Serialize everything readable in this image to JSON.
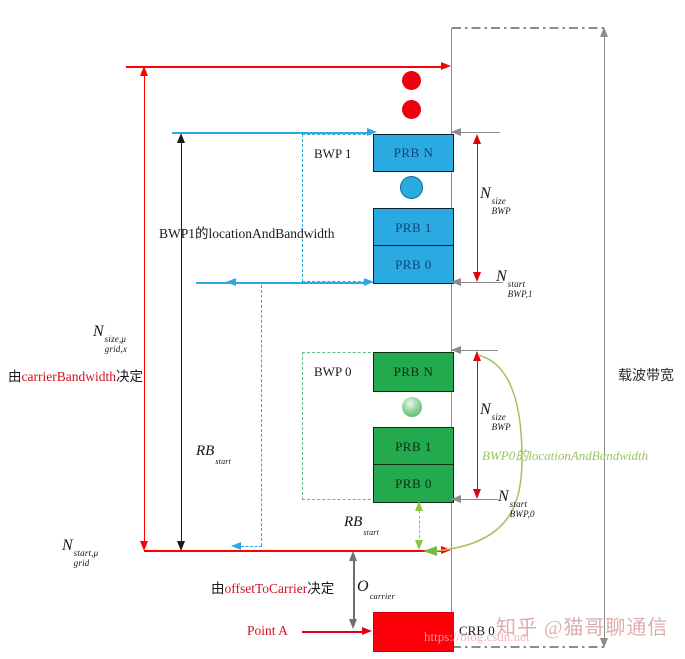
{
  "diagram": {
    "grid": {
      "n_size": {
        "base": "N",
        "sup": "size,μ",
        "sub": "grid,x"
      },
      "n_start": {
        "base": "N",
        "sup": "start,μ",
        "sub": "grid"
      },
      "carrier_note": {
        "prefix": "由",
        "keyword": "carrierBandwidth",
        "suffix": "决定"
      },
      "offset_note": {
        "prefix": "由",
        "keyword": "offsetToCarrier",
        "suffix": "决定"
      },
      "o_carrier": {
        "base": "O",
        "sub": "carrier"
      },
      "point_a_label": "Point A",
      "crb0_label": "CRB 0"
    },
    "bwp1": {
      "label": "BWP 1",
      "prb": [
        "PRB N",
        "PRB 1",
        "PRB 0"
      ],
      "location_label": "BWP1的locationAndBandwidth",
      "rb_start": {
        "base": "RB",
        "sub": "start"
      },
      "n_size": {
        "base": "N",
        "sup": "size",
        "sub": "BWP"
      },
      "n_start": {
        "base": "N",
        "sup": "start",
        "sub": "BWP,1"
      }
    },
    "bwp0": {
      "label": "BWP 0",
      "prb": [
        "PRB N",
        "PRB 1",
        "PRB 0"
      ],
      "location_label": "BWP0的locationAndBandwidth",
      "rb_start": {
        "base": "RB",
        "sub": "start"
      },
      "n_size": {
        "base": "N",
        "sup": "size",
        "sub": "BWP"
      },
      "n_start": {
        "base": "N",
        "sup": "start",
        "sub": "BWP,0"
      }
    },
    "carrier_bandwidth_label": "载波带宽",
    "watermark": {
      "zhihu": "知乎 @猫哥聊通信",
      "url": "https://blog.csdn.net"
    },
    "colors": {
      "cyan": "#29abe2",
      "green_fill": "#23aa4e",
      "green_dash": "#5abf7f",
      "light_green": "#8cc63f",
      "olive_curve": "#a8c060",
      "red": "#ff0000",
      "text_red": "#cf1322",
      "gray": "#8c8c8c"
    }
  }
}
